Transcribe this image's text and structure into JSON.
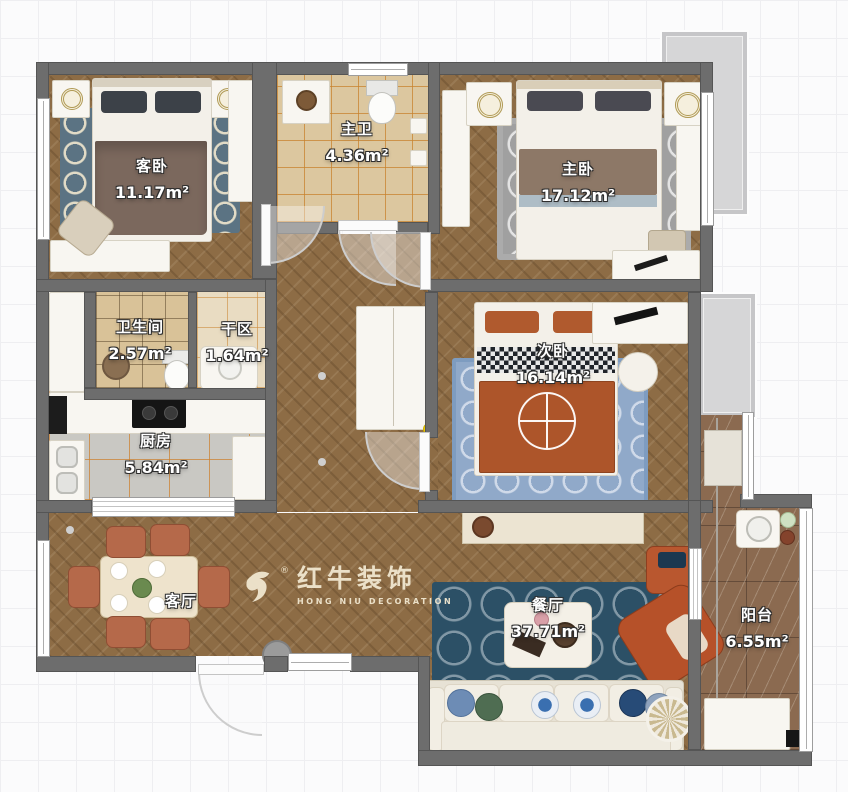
{
  "watermark": {
    "brand_cn": "红牛装饰",
    "brand_en": "HONG NIU DECORATION",
    "registered": "®"
  },
  "rooms": [
    {
      "id": "guest_bedroom",
      "name": "客卧",
      "area": "11.17m²"
    },
    {
      "id": "master_bath",
      "name": "主卫",
      "area": "4.36m²"
    },
    {
      "id": "master_bedroom",
      "name": "主卧",
      "area": "17.12m²"
    },
    {
      "id": "bathroom",
      "name": "卫生间",
      "area": "2.57m²"
    },
    {
      "id": "dry_area",
      "name": "干区",
      "area": "1.64m²"
    },
    {
      "id": "second_bedroom",
      "name": "次卧",
      "area": "16.14m²"
    },
    {
      "id": "kitchen",
      "name": "厨房",
      "area": "5.84m²"
    },
    {
      "id": "living_room",
      "name": "客厅",
      "area": ""
    },
    {
      "id": "dining_room",
      "name": "餐厅",
      "area": "37.71m²"
    },
    {
      "id": "balcony",
      "name": "阳台",
      "area": "6.55m²"
    }
  ],
  "colors": {
    "wall": "#6d6d6d",
    "wood_floor": "#8d6c45",
    "guest_rug": "#5b7383",
    "master_rug": "#a0a0a0",
    "living_rug": "#2c5066",
    "second_rug": "#90a9c9",
    "terracotta_chair": "#b5694a",
    "orange_blanket": "#ad552a",
    "watermark_cream": "#efe6cf",
    "highlight_dot": "#f2cf00"
  }
}
